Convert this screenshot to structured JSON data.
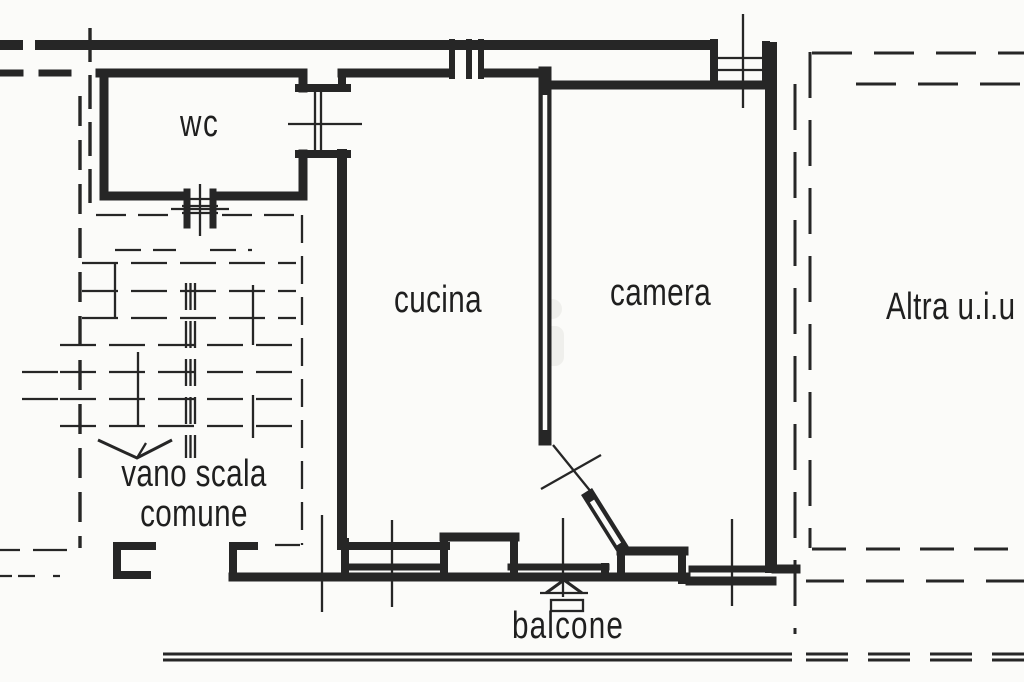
{
  "colors": {
    "ink": "#262626",
    "paper": "#fbfbf9",
    "label_ink": "#1f1f1f",
    "watermark": "#ecece8"
  },
  "rooms": {
    "wc": {
      "label": "wc"
    },
    "cucina": {
      "label": "cucina"
    },
    "camera": {
      "label": "camera"
    },
    "vano_scala": {
      "label_line1": "vano scala",
      "label_line2": "comune"
    },
    "balcone": {
      "label": "balcone"
    },
    "altra_unita": {
      "label": "Altra u.i.u"
    }
  }
}
